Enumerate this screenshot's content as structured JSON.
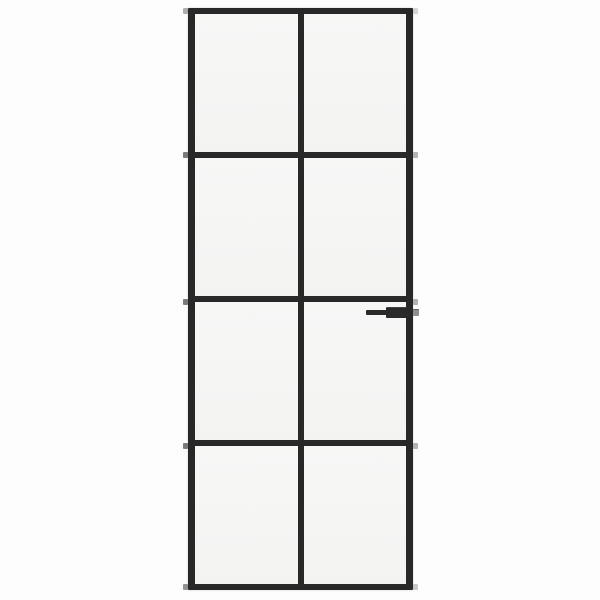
{
  "scene": {
    "type": "product-photo",
    "description": "Narrow interior door with black metal frame and frosted-clear glass panes arranged in a 2 by 4 grid, lever handle mounted on the right stile below the second cross rail, shown on a plain white background",
    "background_color": "#fdfdfd"
  },
  "door": {
    "frame_color": "#282828",
    "glass_color": "#f5f5f4",
    "grid": {
      "columns": 2,
      "rows": 4,
      "pane_count": 8
    },
    "rails": {
      "count_horizontal": 5,
      "end_nub_left_color": "#4f4f4f",
      "end_nub_right_color": "#a6a6a6"
    },
    "handle": {
      "side": "right",
      "style": "lever",
      "color": "#2a2a2a",
      "latch_color": "#8f8f8f",
      "position_row": "below second cross rail"
    }
  }
}
